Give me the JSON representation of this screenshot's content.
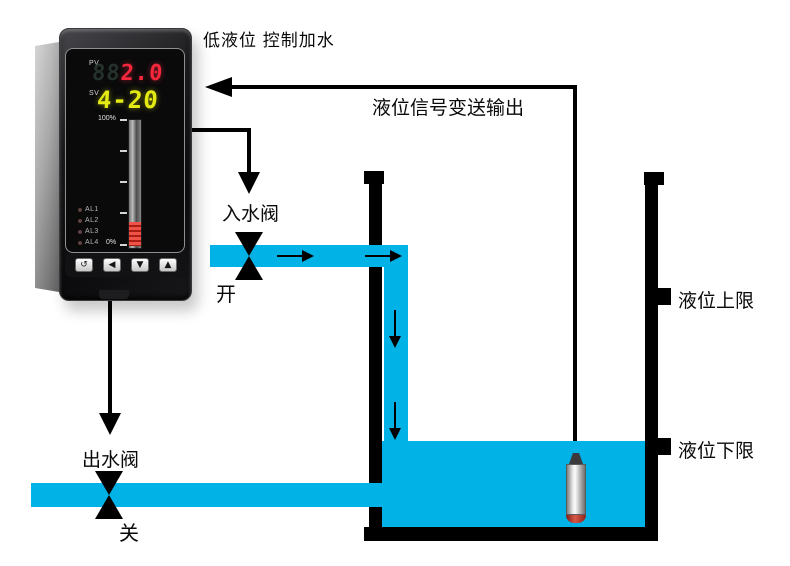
{
  "diagram": {
    "title": "低液位 控制加水",
    "signal_label": "液位信号变送输出",
    "inlet_valve": {
      "label": "入水阀",
      "state": "开"
    },
    "outlet_valve": {
      "label": "出水阀",
      "state": "关"
    },
    "limits": {
      "upper": "液位上限",
      "lower": "液位下限"
    }
  },
  "controller": {
    "pv_label": "PV",
    "pv_ghost": "88",
    "pv_value": "2.0",
    "sv_label": "SV",
    "sv_value": "4-20",
    "scale": {
      "top": "100%",
      "bottom": "0%"
    },
    "alarm_labels": [
      "AL1",
      "AL2",
      "AL3",
      "AL4"
    ],
    "buttons": [
      {
        "name": "loop-set-key",
        "glyph": "↺"
      },
      {
        "name": "shift-key",
        "glyph": "◀"
      },
      {
        "name": "down-key",
        "glyph": "▼"
      },
      {
        "name": "up-key",
        "glyph": "▲"
      }
    ]
  },
  "colors": {
    "water": "#00b2e5",
    "line": "#000000",
    "pv_red": "#f5273d",
    "sv_yellow": "#e4ea12",
    "bar_red": "#a81d14"
  }
}
